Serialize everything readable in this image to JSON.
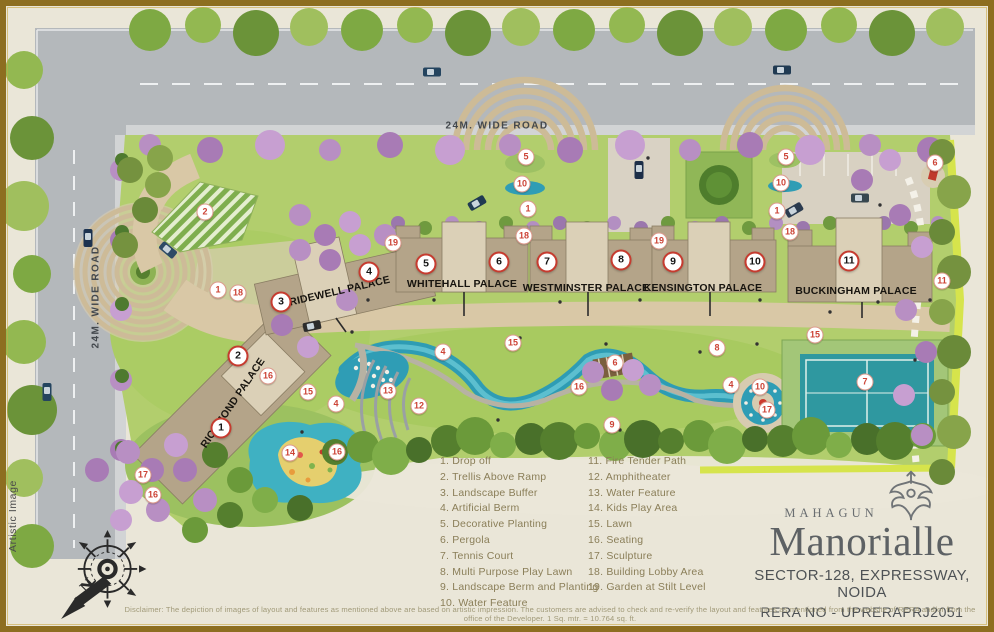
{
  "map": {
    "roads": {
      "top_label": "24M. WIDE ROAD",
      "left_label": "24M. WIDE ROAD"
    },
    "buildings": [
      {
        "name": "RICHMOND PALACE"
      },
      {
        "name": "BRIDEWELL PALACE"
      },
      {
        "name": "WHITEHALL PALACE"
      },
      {
        "name": "WESTMINSTER PALACE"
      },
      {
        "name": "KENSINGTON PALACE"
      },
      {
        "name": "BUCKINGHAM PALACE"
      }
    ],
    "tower_badges": [
      {
        "n": "1",
        "x": 221,
        "y": 428
      },
      {
        "n": "2",
        "x": 238,
        "y": 356
      },
      {
        "n": "3",
        "x": 281,
        "y": 302
      },
      {
        "n": "4",
        "x": 369,
        "y": 272
      },
      {
        "n": "5",
        "x": 426,
        "y": 264
      },
      {
        "n": "6",
        "x": 499,
        "y": 262
      },
      {
        "n": "7",
        "x": 547,
        "y": 262
      },
      {
        "n": "8",
        "x": 621,
        "y": 260
      },
      {
        "n": "9",
        "x": 673,
        "y": 262
      },
      {
        "n": "10",
        "x": 755,
        "y": 262
      },
      {
        "n": "11",
        "x": 849,
        "y": 261
      }
    ],
    "feature_badges": [
      {
        "n": "2",
        "x": 205,
        "y": 212
      },
      {
        "n": "5",
        "x": 526,
        "y": 157
      },
      {
        "n": "10",
        "x": 522,
        "y": 184
      },
      {
        "n": "1",
        "x": 528,
        "y": 209
      },
      {
        "n": "18",
        "x": 524,
        "y": 236
      },
      {
        "n": "5",
        "x": 786,
        "y": 157
      },
      {
        "n": "10",
        "x": 781,
        "y": 183
      },
      {
        "n": "1",
        "x": 777,
        "y": 211
      },
      {
        "n": "18",
        "x": 790,
        "y": 232
      },
      {
        "n": "19",
        "x": 393,
        "y": 243
      },
      {
        "n": "19",
        "x": 659,
        "y": 241
      },
      {
        "n": "6",
        "x": 935,
        "y": 163
      },
      {
        "n": "11",
        "x": 942,
        "y": 281
      },
      {
        "n": "1",
        "x": 218,
        "y": 290
      },
      {
        "n": "18",
        "x": 238,
        "y": 293
      },
      {
        "n": "16",
        "x": 268,
        "y": 376
      },
      {
        "n": "15",
        "x": 308,
        "y": 392
      },
      {
        "n": "4",
        "x": 336,
        "y": 404
      },
      {
        "n": "13",
        "x": 388,
        "y": 391
      },
      {
        "n": "12",
        "x": 419,
        "y": 406
      },
      {
        "n": "15",
        "x": 513,
        "y": 343
      },
      {
        "n": "4",
        "x": 443,
        "y": 352
      },
      {
        "n": "6",
        "x": 615,
        "y": 363
      },
      {
        "n": "16",
        "x": 579,
        "y": 387
      },
      {
        "n": "8",
        "x": 717,
        "y": 348
      },
      {
        "n": "4",
        "x": 731,
        "y": 385
      },
      {
        "n": "9",
        "x": 612,
        "y": 425
      },
      {
        "n": "15",
        "x": 815,
        "y": 335
      },
      {
        "n": "7",
        "x": 865,
        "y": 382
      },
      {
        "n": "10",
        "x": 760,
        "y": 387
      },
      {
        "n": "17",
        "x": 767,
        "y": 410
      },
      {
        "n": "14",
        "x": 290,
        "y": 453
      },
      {
        "n": "16",
        "x": 337,
        "y": 452
      },
      {
        "n": "17",
        "x": 143,
        "y": 475
      },
      {
        "n": "16",
        "x": 153,
        "y": 495
      }
    ]
  },
  "legend": {
    "columns": [
      [
        {
          "num": "1",
          "label": "Drop off"
        },
        {
          "num": "2",
          "label": "Trellis Above Ramp"
        },
        {
          "num": "3",
          "label": "Landscape Buffer"
        },
        {
          "num": "4",
          "label": "Artificial Berm"
        },
        {
          "num": "5",
          "label": "Decorative Planting"
        },
        {
          "num": "6",
          "label": "Pergola"
        },
        {
          "num": "7",
          "label": "Tennis Court"
        },
        {
          "num": "8",
          "label": "Multi Purpose Play Lawn"
        },
        {
          "num": "9",
          "label": "Landscape Berm and Planting"
        },
        {
          "num": "10",
          "label": "Water Feature"
        }
      ],
      [
        {
          "num": "11",
          "label": "Fire Tender Path"
        },
        {
          "num": "12",
          "label": "Amphitheater"
        },
        {
          "num": "13",
          "label": "Water Feature"
        },
        {
          "num": "14",
          "label": "Kids Play Area"
        },
        {
          "num": "15",
          "label": "Lawn"
        },
        {
          "num": "16",
          "label": "Seating"
        },
        {
          "num": "17",
          "label": "Sculpture"
        },
        {
          "num": "18",
          "label": "Building Lobby Area"
        },
        {
          "num": "19",
          "label": "Garden at Stilt Level"
        }
      ]
    ]
  },
  "brand": {
    "developer": "MAHAGUN",
    "project": "Manorialle",
    "location": "SECTOR-128, EXPRESSWAY, NOIDA",
    "rera": "RERA NO - UPRERAPRJ2051"
  },
  "notes": {
    "artistic": "Artistic Image",
    "disclaimer": "Disclaimer: The depiction of images of layout and features as mentioned above are based on artistic impression. The customers are advised to check and re-verify the layout and features as mentioned from the website of RERA and/or from the office of the Developer. 1 Sq. mtr. = 10.764 sq. ft."
  },
  "compass": {
    "north": "N"
  },
  "colors": {
    "frame": "#8d6e20",
    "paper": "#eae6d8",
    "lawn": "#b2ce6d",
    "road": "#b4b8bb",
    "building": "#b4a489",
    "water": "#2f9db5",
    "badge_red": "#c63b2f"
  }
}
